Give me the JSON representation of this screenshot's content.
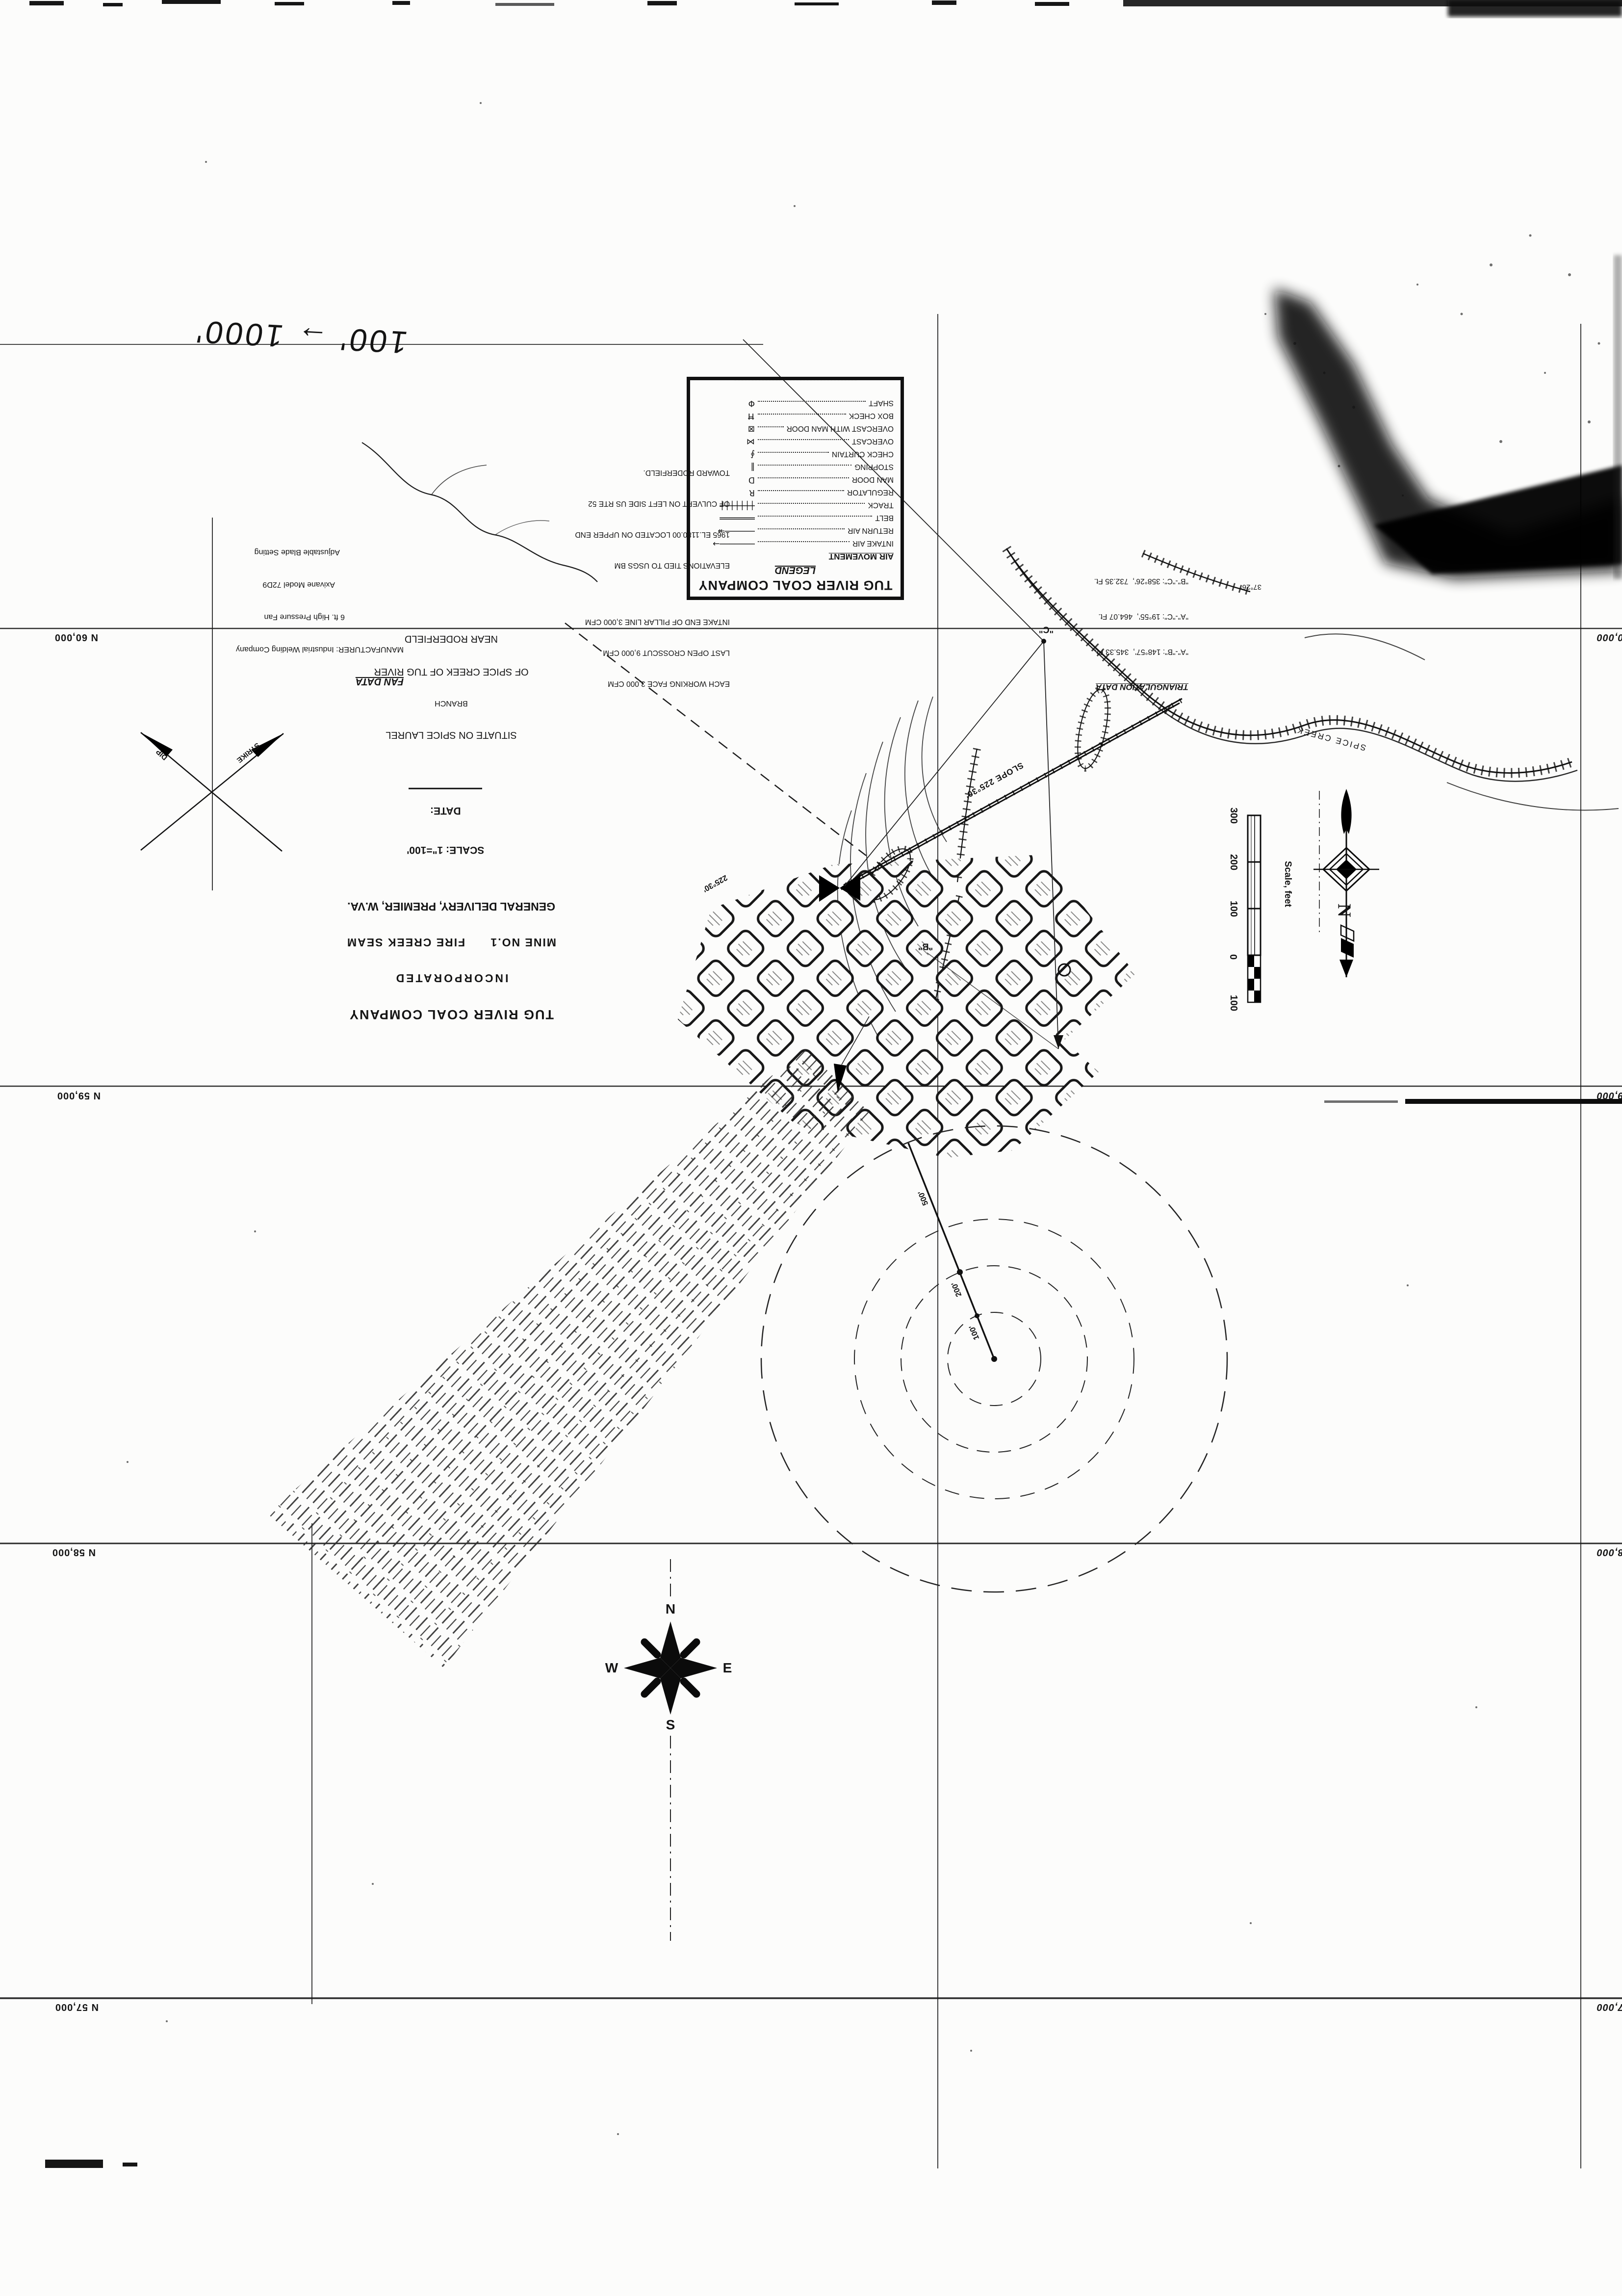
{
  "annotations": {
    "handwritten_note": "100' → 1000'",
    "bearing_note": "37°26'"
  },
  "legend": {
    "company": "TUG RIVER COAL COMPANY",
    "title": "LEGEND",
    "section": "AIR MOVEMENT",
    "rows": [
      {
        "label": "INTAKE AIR",
        "symbol": "───────→"
      },
      {
        "label": "RETURN AIR",
        "symbol": "──────↠"
      },
      {
        "label": "BELT",
        "symbol": "═══════"
      },
      {
        "label": "TRACK",
        "symbol": "┼┼┼┼┼┼┼"
      },
      {
        "label": "REGULATOR",
        "symbol": "R"
      },
      {
        "label": "MAN DOOR",
        "symbol": "D"
      },
      {
        "label": "STOPPING",
        "symbol": "‖"
      },
      {
        "label": "CHECK CURTAIN",
        "symbol": "∮"
      },
      {
        "label": "OVERCAST",
        "symbol": "⋈"
      },
      {
        "label": "OVERCAST WITH MAN DOOR",
        "symbol": "⊠"
      },
      {
        "label": "BOX CHECK",
        "symbol": "Ħ"
      },
      {
        "label": "SHAFT",
        "symbol": "Φ"
      }
    ]
  },
  "title_block": {
    "company": "TUG RIVER COAL COMPANY",
    "incorporated": "INCORPORATED",
    "mine_line": "MINE NO.1      FIRE CREEK SEAM",
    "address": "GENERAL DELIVERY, PREMIER, W.VA.",
    "scale_label": "SCALE: 1\"=100'",
    "date_label": "DATE:",
    "situate": "SITUATE ON SPICE LAUREL",
    "branch": "BRANCH",
    "of_creek": "OF SPICE CREEK OF TUG RIVER",
    "near": "NEAR RODERFIELD"
  },
  "fan_data": {
    "title": "FAN DATA",
    "manufacturer": "MANUFACTURER: Industrial Welding Company",
    "line2": "6 ft. High Pressure Fan",
    "line3": "Axivane Model 72D9",
    "line4": "Adjustable Blade Setting"
  },
  "ventilation_notes": {
    "line1": "EACH WORKING FACE 3,000 CFM",
    "line2": "LAST OPEN CROSSCUT 9,000 CFM",
    "line3": "INTAKE END OF PILLAR LINE 3,000 CFM",
    "line4": "ELEVATIONS TIED TO USGS BM",
    "line5": "1965 EL.1180.00 LOCATED ON UPPER END",
    "line6": "OF CULVERT ON LEFT SIDE US RTE 52",
    "line7": "TOWARD RODERFIELD."
  },
  "triangulation": {
    "title": "TRIANGULATION DATA",
    "row1": "\"A\"-\"B\": 148°57',  345.33 Ft.",
    "row2": "\"A\"-\"C\": 19°55',  464.07 Ft.",
    "row3": "\"B\"-\"C\": 358°26',  732.35 Ft."
  },
  "map_labels": {
    "slope": "SLOPE 225°30'",
    "heading_bearing": "225°30'",
    "creek": "SPICE CREEK",
    "station_b": "\"B\"",
    "station_c": "\"C\"",
    "dip": "DIP",
    "strike": "STRIKE",
    "r500": "500'",
    "r200": "200'",
    "r100": "100'"
  },
  "grid": {
    "left_labels": [
      "N 60,000",
      "N 59,000",
      "N 58,000",
      "N 57,000"
    ],
    "right_labels": [
      "60,000",
      "59,000",
      "58,000",
      "57,000"
    ]
  },
  "scale_bar": {
    "t300": "300",
    "t200": "200",
    "t100": "100",
    "t0": "0",
    "t100b": "100",
    "caption": "Scale, feet"
  },
  "compass": {
    "n": "N",
    "e": "E",
    "s": "S",
    "w": "W"
  },
  "north_arrow": {
    "label": "N"
  }
}
